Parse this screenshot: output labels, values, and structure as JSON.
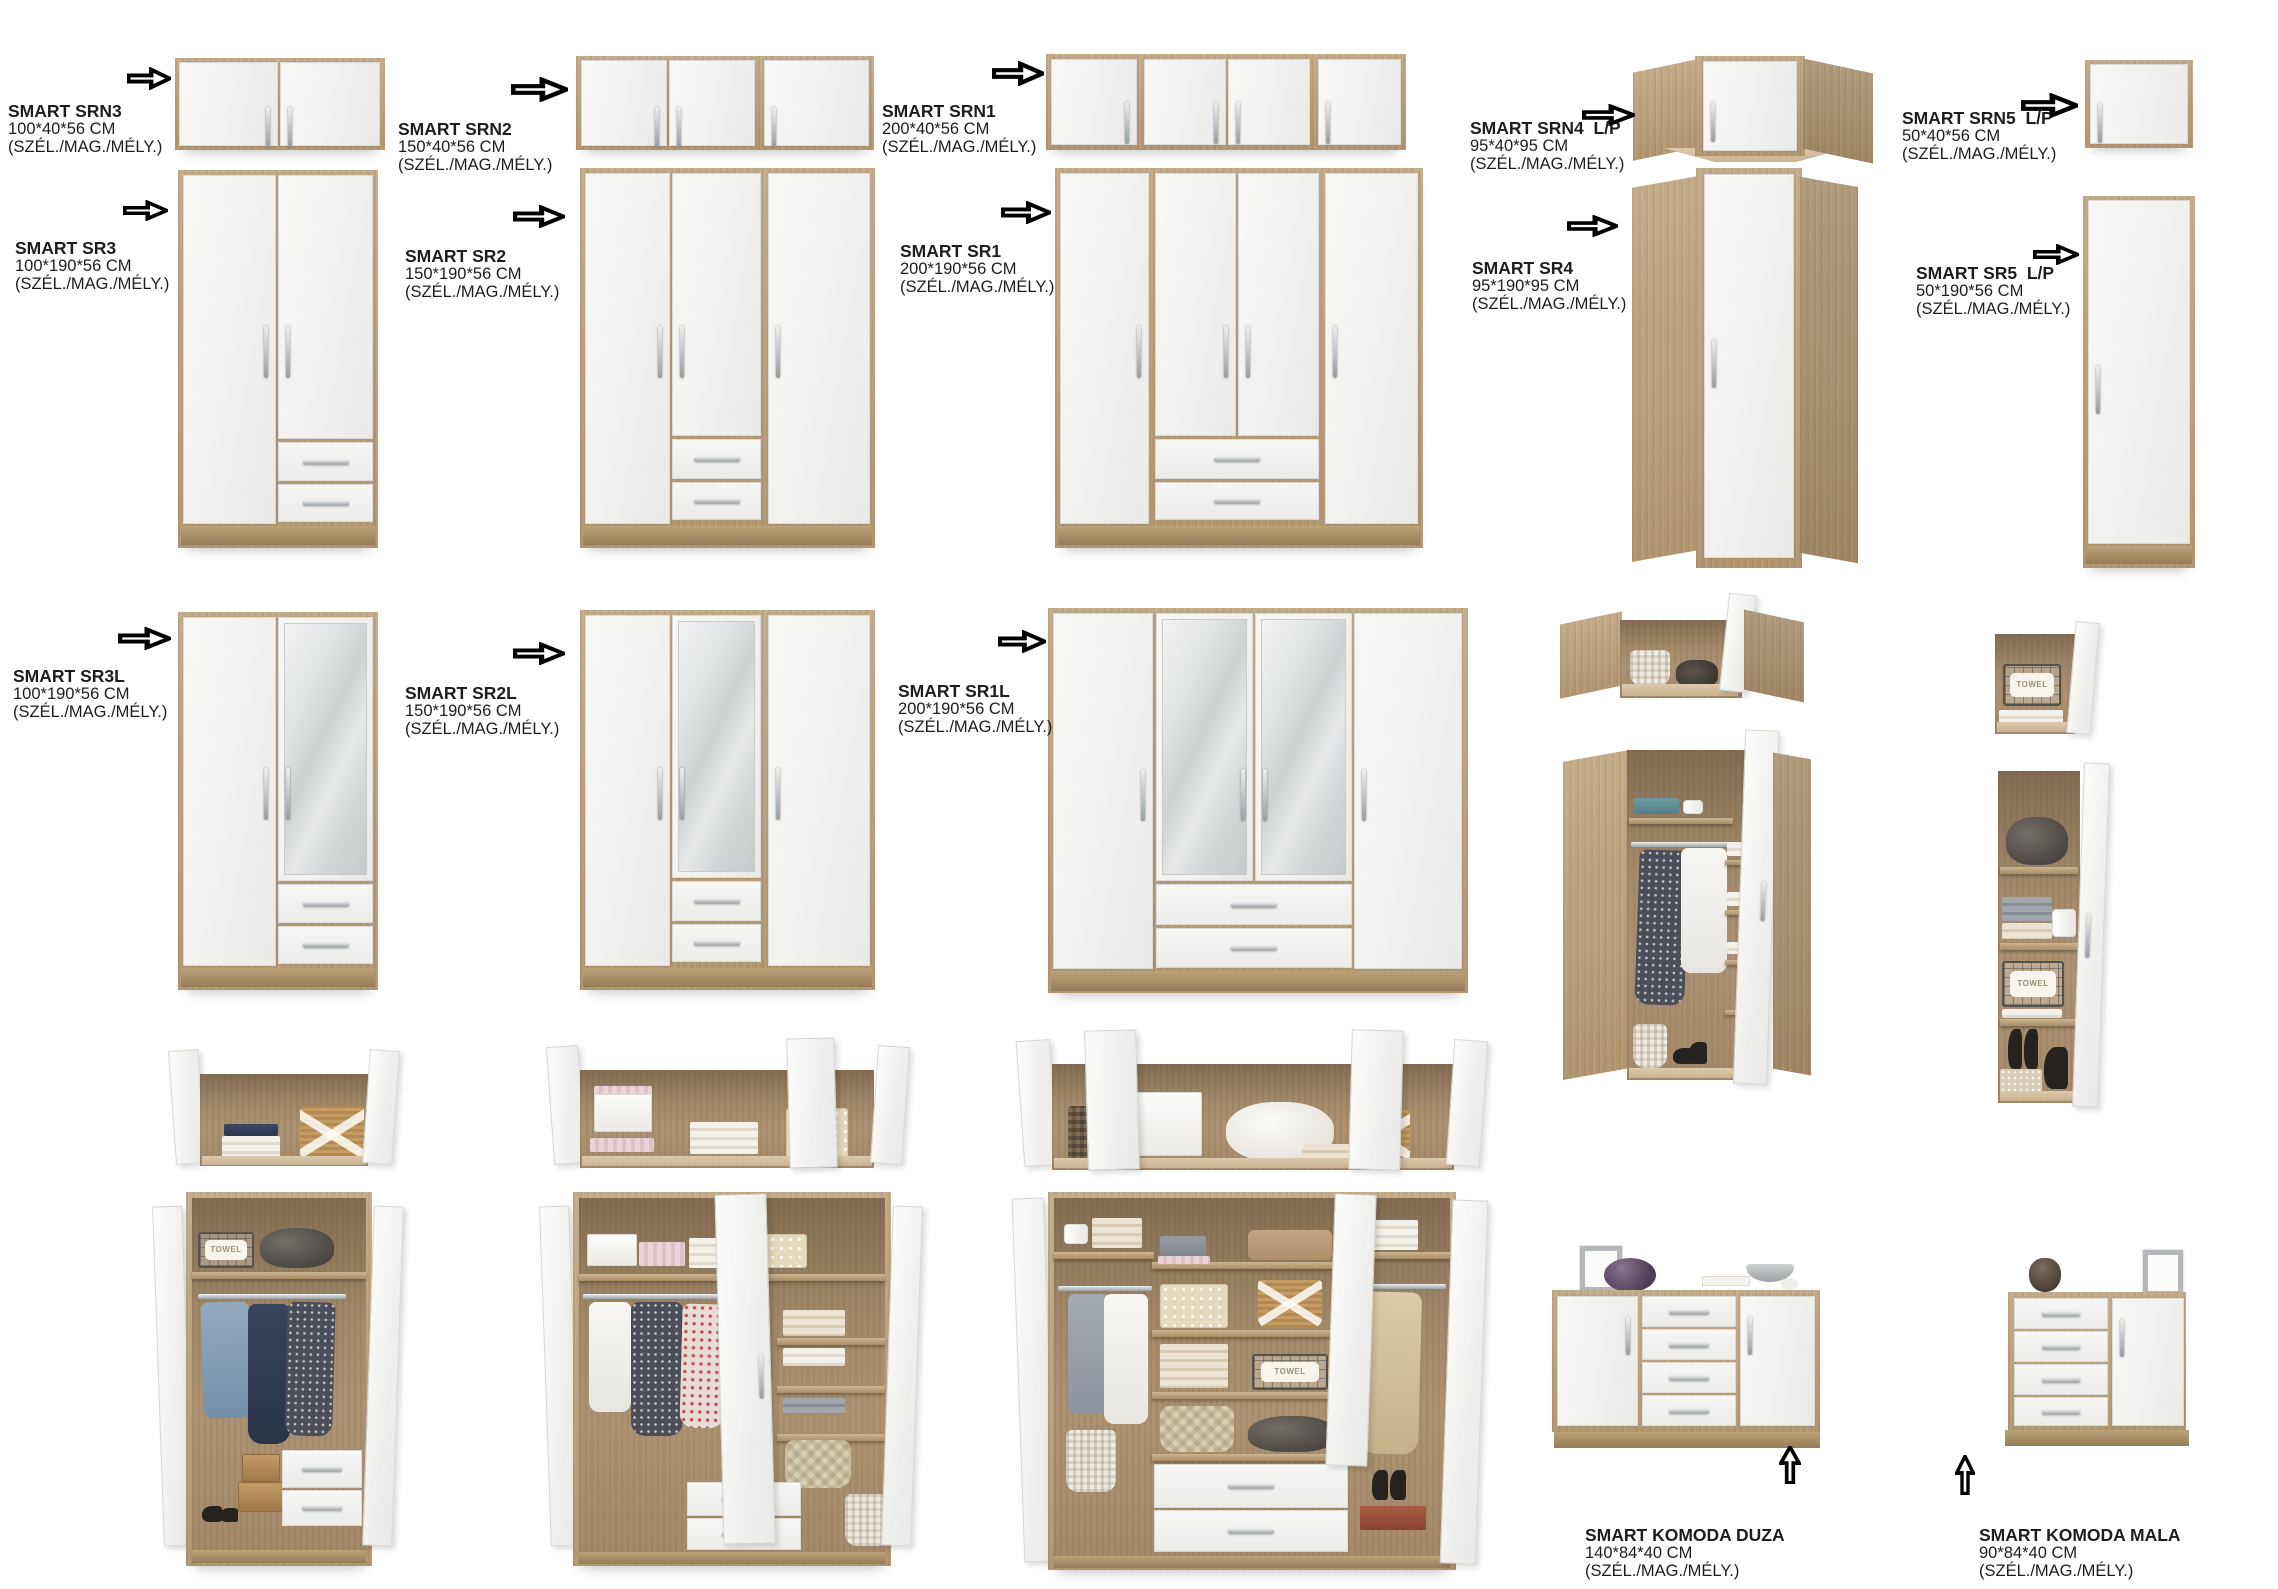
{
  "page": {
    "type": "furniture-catalog",
    "background": "#ffffff"
  },
  "shared": {
    "spec": "(SZÉL./MAG./MÉLY.)",
    "towel": "TOWEL"
  },
  "palette": {
    "oak": "#b99f7d",
    "oak_dark": "#967c58",
    "front_white": "#f3f3f1",
    "mirror": "#d4d8d9",
    "handle": "#9aa0a3",
    "text": "#1d1d1d",
    "arrow_outline": "#000000"
  },
  "icons": {
    "arrow_right": "block-arrow-right",
    "arrow_up": "block-arrow-up"
  },
  "products": {
    "srn3": {
      "name": "SMART SRN3",
      "dims": "100*40*56 CM"
    },
    "srn2": {
      "name": "SMART SRN2",
      "dims": "150*40*56 CM"
    },
    "srn1": {
      "name": "SMART SRN1",
      "dims": "200*40*56 CM"
    },
    "srn4": {
      "name": "SMART SRN4  L/P",
      "dims": "95*40*95 CM"
    },
    "srn5": {
      "name": "SMART SRN5  L/P",
      "dims": "50*40*56 CM"
    },
    "sr3": {
      "name": "SMART SR3",
      "dims": "100*190*56 CM"
    },
    "sr2": {
      "name": "SMART SR2",
      "dims": "150*190*56 CM"
    },
    "sr1": {
      "name": "SMART SR1",
      "dims": "200*190*56 CM"
    },
    "sr4": {
      "name": "SMART SR4",
      "dims": "95*190*95 CM"
    },
    "sr5": {
      "name": "SMART SR5  L/P",
      "dims": "50*190*56 CM"
    },
    "sr3l": {
      "name": "SMART SR3L",
      "dims": "100*190*56 CM"
    },
    "sr2l": {
      "name": "SMART SR2L",
      "dims": "150*190*56 CM"
    },
    "sr1l": {
      "name": "SMART SR1L",
      "dims": "200*190*56 CM"
    },
    "komoda_duza": {
      "name": "SMART KOMODA DUZA",
      "dims": "140*84*40 CM"
    },
    "komoda_mala": {
      "name": "SMART KOMODA MALA",
      "dims": "90*84*40 CM"
    }
  }
}
